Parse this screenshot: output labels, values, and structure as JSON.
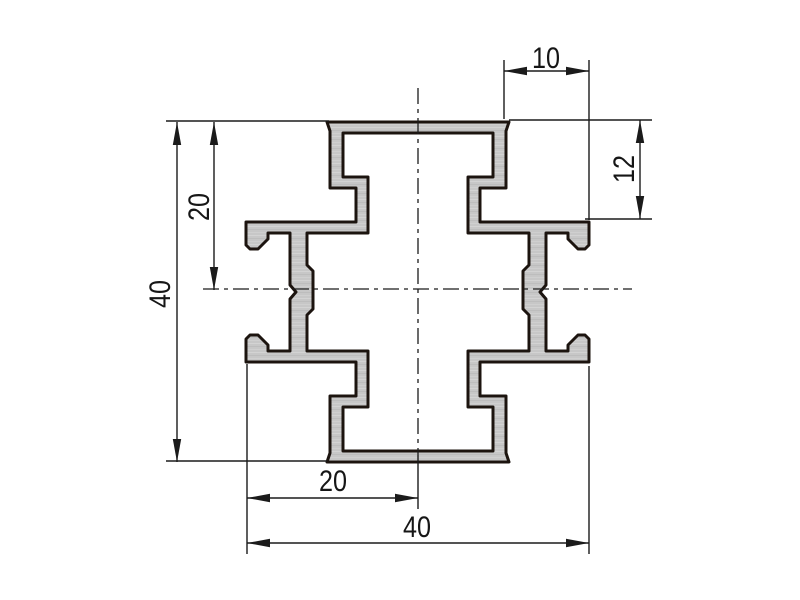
{
  "drawing": {
    "background_color": "#ffffff",
    "line_color": "#1b1b1b",
    "profile_fill_color": "#c7c7c7",
    "profile_outline_color": "#1c140f",
    "dimensions": {
      "top_width": "10",
      "right_height": "12",
      "left_upper_height": "20",
      "left_total_height": "40",
      "bottom_half_width": "20",
      "bottom_total_width": "40"
    }
  }
}
